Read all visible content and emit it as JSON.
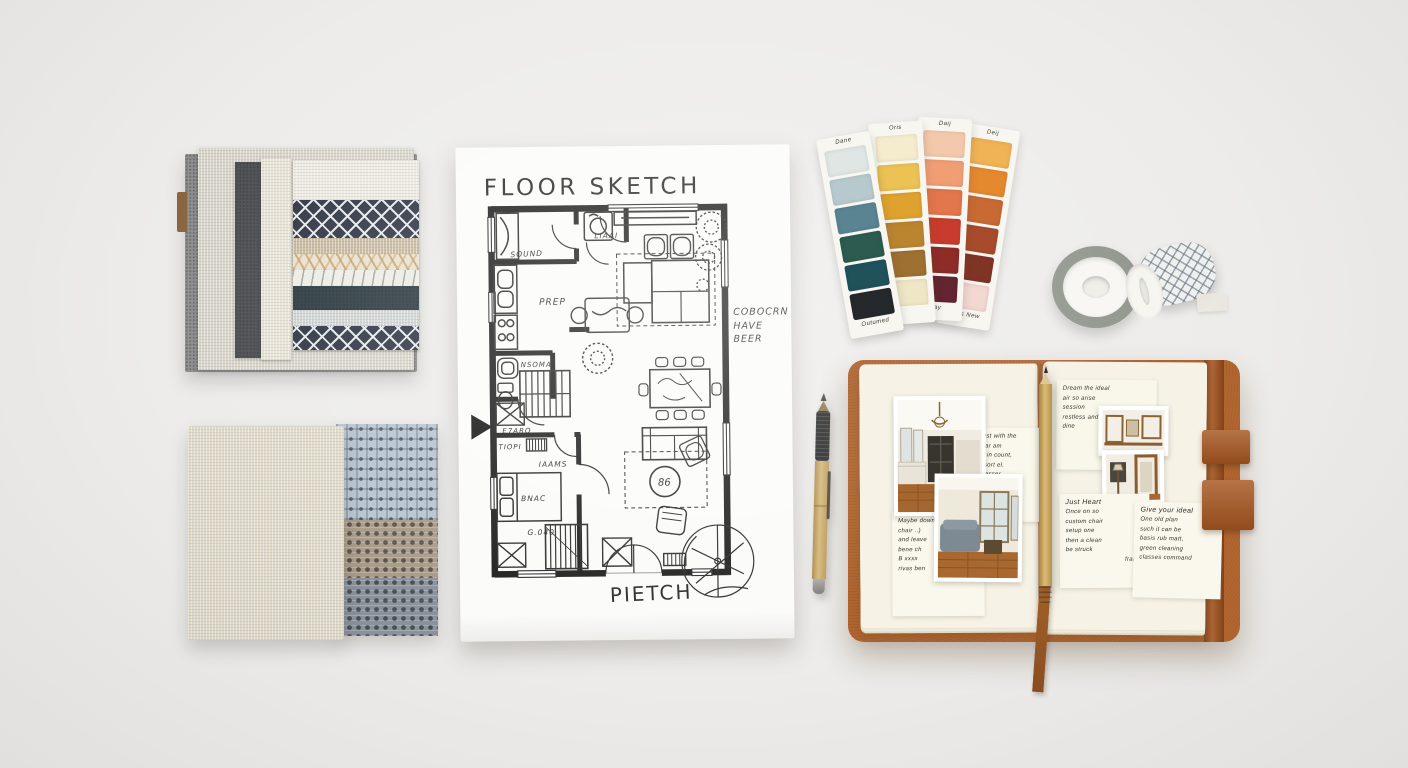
{
  "scene": {
    "surface_color": "#edecea"
  },
  "fabric_book": {
    "base_color": "#8e8f8e",
    "tab_color": "#8a6540",
    "layer_colors": [
      "#d7d3c8",
      "#4d5053",
      "#e6e2d5"
    ],
    "swatches": [
      {
        "name": "cream-weave",
        "color": "#ece9e0"
      },
      {
        "name": "navy-lattice",
        "color": "#2e3442"
      },
      {
        "name": "tan-weave",
        "color": "#c6b79c"
      },
      {
        "name": "cream-trellis",
        "color": "#e9e1cd"
      },
      {
        "name": "ivory-scroll",
        "color": "#edece6"
      },
      {
        "name": "dark-teal",
        "color": "#2b3a40"
      },
      {
        "name": "pale-gray",
        "color": "#ced4d2"
      },
      {
        "name": "navy-lattice",
        "color": "#2e3442"
      }
    ]
  },
  "linen_swatches": {
    "large_color": "#ded9c8",
    "checks": [
      {
        "name": "blue-plaid",
        "color": "#b7c5d2"
      },
      {
        "name": "taupe-dots",
        "color": "#a89a87"
      },
      {
        "name": "gray-dots",
        "color": "#8a929c"
      }
    ]
  },
  "floor_plan": {
    "title": "FLOOR SKETCH",
    "footer": "PIETCH",
    "annotation": [
      "COBOCRN",
      "HAVE",
      "BEER"
    ],
    "labels": {
      "closet": "SOUND",
      "entry": "LIAAI",
      "kitchen": "PREP",
      "bath": "NSOMA",
      "cupboard": "E7ARO",
      "landing": "TIOPI",
      "hall": "IAAMS",
      "bedroom": "BNAC",
      "bedroom_size": "G.040",
      "table_tag": "86"
    },
    "ink_color": "#222222",
    "gold_color": "#b8932f"
  },
  "paint_cards": [
    {
      "top_label": "Dane",
      "bottom_label": "Outumed",
      "chips": [
        "#e0e6e4",
        "#b6cace",
        "#5a8492",
        "#2c5b50",
        "#20525c",
        "#26292b"
      ]
    },
    {
      "top_label": "Oris",
      "bottom_label": "",
      "chips": [
        "#f5ecce",
        "#ecc254",
        "#dfa22e",
        "#bb8530",
        "#9e7031",
        "#efe6c6"
      ]
    },
    {
      "top_label": "Daij",
      "bottom_label": "Pay",
      "chips": [
        "#f4c9ab",
        "#f19e74",
        "#e3764b",
        "#c93c2d",
        "#8e2c28",
        "#63252f"
      ]
    },
    {
      "top_label": "Deij",
      "bottom_label": "Russ New",
      "chips": [
        "#f0b355",
        "#e5892f",
        "#c96a33",
        "#a84b2c",
        "#803425",
        "#f2d8d0"
      ]
    }
  ],
  "washi": {
    "plain_roll_edge": "#8d9289",
    "core": "#f7f6f2",
    "pattern_base": "#eef0ee"
  },
  "pens": {
    "bamboo_pen_body": "#c8a768",
    "pencil_body": "#c7a25c"
  },
  "notebook": {
    "cover_color": "#b2662f",
    "strap_color": "#a6551f",
    "page_color": "#f6f3e6",
    "ribbon_color": "#9a5b28",
    "left_page": {
      "sticky_note_lines": [
        "Dust with the",
        "char am",
        "all in count,",
        "resort el.",
        "Dresser"
      ],
      "margin_note_lines": [
        "Maybe down",
        "chair ..)",
        "and leave",
        "bene ch",
        "B xxxx",
        "rivas ben"
      ]
    },
    "right_page": {
      "top_note_lines": [
        "Dream the ideal",
        "air so arise",
        "session",
        "restless and",
        "dine"
      ],
      "note_a_title": "Just Heart",
      "note_a_lines": [
        "Once on so",
        "custom chair",
        "setup one",
        "then a clean",
        "be struck",
        "frame!"
      ],
      "note_b_title": "Give your ideal",
      "note_b_lines": [
        "One old plan",
        "such it can be",
        "basis rub matt,",
        "green cleaning",
        "classes command"
      ]
    }
  }
}
